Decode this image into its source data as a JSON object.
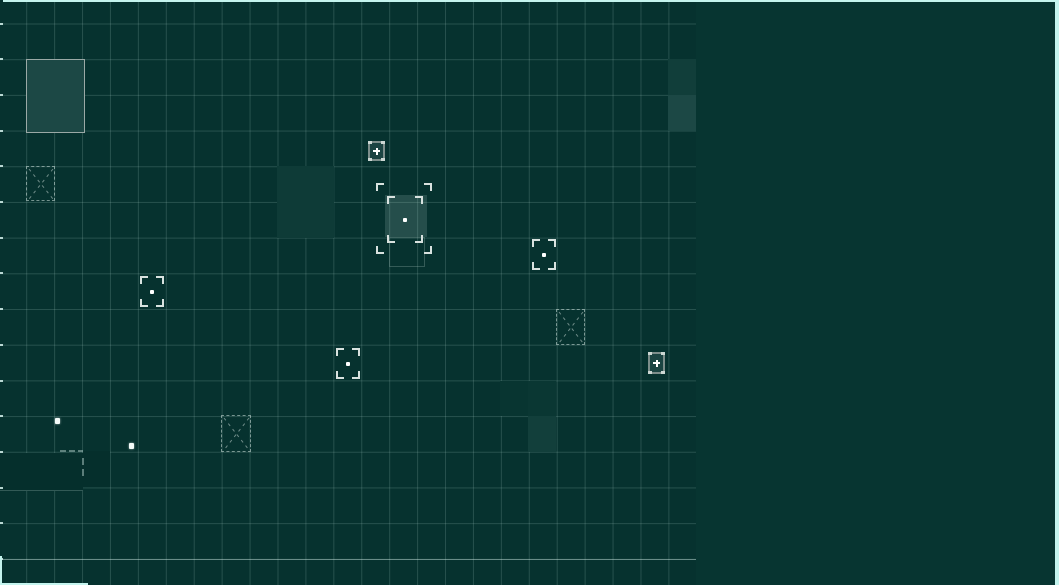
{
  "canvas": {
    "width": 1059,
    "height": 585
  },
  "colors": {
    "bg_grid": "#06322f",
    "bg_panel": "#073531",
    "grid_line": "rgba(168,205,198,0.20)",
    "border_cyan": "#c4f4ee",
    "bright_hline": "rgba(215,240,234,0.40)",
    "fog_fill": "#052f2c",
    "fog_edge": "rgba(170,205,198,0.28)"
  },
  "grid": {
    "area_width": 696,
    "offset_x": 26.2,
    "offset_y": 23.5,
    "cell_w": 27.93,
    "cell_h": 35.7,
    "tick_count": 16,
    "bright_hline_y": 559
  },
  "border_segments": [
    {
      "name": "viewport-border-top",
      "x": 3,
      "y": 0,
      "w": 1056,
      "h": 2
    },
    {
      "name": "viewport-border-right",
      "x": 1055,
      "y": 0,
      "w": 4,
      "h": 585
    },
    {
      "name": "viewport-border-bottom",
      "x": 0,
      "y": 583,
      "w": 88,
      "h": 2
    },
    {
      "name": "viewport-border-left",
      "x": 0,
      "y": 556,
      "w": 2,
      "h": 29
    }
  ],
  "highlights": [
    {
      "x": 26,
      "y": 59,
      "w": 57,
      "h": 72,
      "fill": "#1c4845",
      "border": "#9aa9a6"
    },
    {
      "x": 668,
      "y": 59,
      "w": 28,
      "h": 36,
      "fill": "#113e3a"
    },
    {
      "x": 668,
      "y": 95,
      "w": 28,
      "h": 36,
      "fill": "#1c4845"
    },
    {
      "x": 277,
      "y": 166,
      "w": 57,
      "h": 72,
      "fill": "#0e3b37"
    },
    {
      "x": 500,
      "y": 381,
      "w": 29,
      "h": 35,
      "fill": "#083531"
    },
    {
      "x": 528,
      "y": 381,
      "w": 28,
      "h": 35,
      "fill": "#0a3733"
    },
    {
      "x": 528,
      "y": 416,
      "w": 28,
      "h": 36,
      "fill": "#123f3b"
    }
  ],
  "fog_patches": [
    {
      "x": 0,
      "y": 453,
      "w": 83,
      "h": 37,
      "edge_bottom": true
    },
    {
      "x": 83,
      "y": 451,
      "w": 27,
      "h": 36,
      "edge_bottom": false
    }
  ],
  "fog_dashes": [
    {
      "x": 60,
      "y": 450,
      "w": 6,
      "h": 2
    },
    {
      "x": 69,
      "y": 450,
      "w": 6,
      "h": 2
    },
    {
      "x": 78,
      "y": 450,
      "w": 5,
      "h": 2
    },
    {
      "x": 82,
      "y": 458,
      "w": 2,
      "h": 7
    },
    {
      "x": 82,
      "y": 469,
      "w": 2,
      "h": 7
    }
  ],
  "plus_box_markers": [
    {
      "x": 368,
      "y": 141,
      "w": 17,
      "h": 20
    },
    {
      "x": 648,
      "y": 352,
      "w": 17,
      "h": 22
    }
  ],
  "bracket_markers": [
    {
      "x": 138,
      "y": 274,
      "w": 28,
      "h": 35
    },
    {
      "x": 334,
      "y": 346,
      "w": 28,
      "h": 35
    },
    {
      "x": 530,
      "y": 237,
      "w": 28,
      "h": 35
    }
  ],
  "dashed_x_markers": [
    {
      "x": 26,
      "y": 166,
      "w": 29,
      "h": 35
    },
    {
      "x": 556,
      "y": 309,
      "w": 29,
      "h": 36
    },
    {
      "x": 221,
      "y": 415,
      "w": 30,
      "h": 37
    }
  ],
  "selection": {
    "outer": {
      "x": 374,
      "y": 181,
      "w": 60,
      "h": 75
    },
    "inner": {
      "x": 385,
      "y": 194,
      "w": 40,
      "h": 51
    },
    "overlay": {
      "x": 385,
      "y": 195,
      "w": 42,
      "h": 42
    },
    "dot": {
      "x": 403,
      "y": 218
    },
    "ghost": {
      "x": 389,
      "y": 237,
      "w": 36,
      "h": 30
    }
  },
  "entity_dots": [
    {
      "x": 55,
      "y": 418
    },
    {
      "x": 129,
      "y": 443
    }
  ]
}
